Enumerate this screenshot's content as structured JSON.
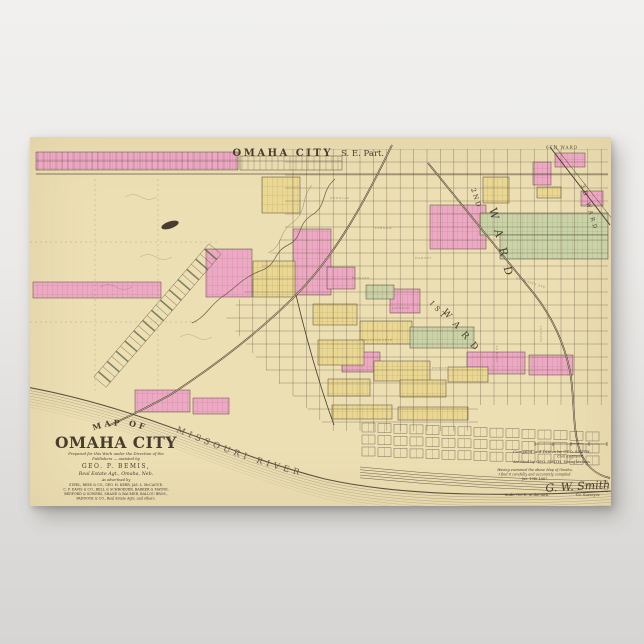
{
  "poster": {
    "paper_color": "#ecdfb4",
    "ink_color": "#473d2f",
    "palette": {
      "pink": "#eda8c3",
      "yellow": "#e9d792",
      "green": "#c9d3a7",
      "grid": "#6d5c44",
      "bank": "#5d5140"
    },
    "map_title": "OMAHA CITY",
    "map_title_suffix": "S. E. Part.",
    "river_label": "MISSOURI   RIVER",
    "ward_labels": [
      {
        "text": "6TH WARD",
        "x": 516,
        "y": 12,
        "r": 0,
        "s": 4.2,
        "ls": 1,
        "o": 0.9
      },
      {
        "text": "2ND",
        "x": 441,
        "y": 52,
        "r": 72,
        "s": 6.5,
        "ls": 2,
        "o": 1
      },
      {
        "text": "WARD",
        "x": 459,
        "y": 72,
        "r": 76,
        "s": 11,
        "ls": 11,
        "o": 1
      },
      {
        "text": "3D WARD",
        "x": 551,
        "y": 48,
        "r": 74,
        "s": 5.5,
        "ls": 3,
        "o": 1
      },
      {
        "text": "1ST",
        "x": 399,
        "y": 166,
        "r": 48,
        "s": 7,
        "ls": 3,
        "o": 1
      },
      {
        "text": "WARD",
        "x": 412,
        "y": 175,
        "r": 50,
        "s": 9,
        "ls": 7,
        "o": 1
      }
    ],
    "street_labels": [
      {
        "text": "DOUGLAS",
        "x": 300,
        "y": 62,
        "r": 0,
        "s": 3
      },
      {
        "text": "FARNAM",
        "x": 345,
        "y": 92,
        "r": 0,
        "s": 3
      },
      {
        "text": "HARNEY",
        "x": 385,
        "y": 122,
        "r": 0,
        "s": 3
      },
      {
        "text": "HOWARD",
        "x": 322,
        "y": 142,
        "r": 0,
        "s": 3
      },
      {
        "text": "JACKSON",
        "x": 362,
        "y": 172,
        "r": 0,
        "s": 3
      },
      {
        "text": "LEAVENWORTH",
        "x": 332,
        "y": 204,
        "r": 0,
        "s": 3
      },
      {
        "text": "PIERCE",
        "x": 402,
        "y": 232,
        "r": 0,
        "s": 3
      },
      {
        "text": "ST. MARYS AVE",
        "x": 486,
        "y": 142,
        "r": 18,
        "s": 3
      },
      {
        "text": "10TH ST",
        "x": 512,
        "y": 205,
        "r": -90,
        "s": 3
      },
      {
        "text": "13TH ST",
        "x": 468,
        "y": 225,
        "r": -90,
        "s": 3
      }
    ],
    "title_block": {
      "arc_text": "MAP OF",
      "name": "OMAHA CITY",
      "lines": [
        {
          "t": "Prepared for this Work under the Direction of the",
          "s": 3.8,
          "y": 318,
          "i": 1
        },
        {
          "t": "Publishers — assisted by",
          "s": 3.8,
          "y": 323,
          "i": 1
        },
        {
          "t": "GEO. P. BEMIS,",
          "s": 6,
          "y": 331,
          "ls": 1.5
        },
        {
          "t": "Real Estate Agt., Omaha, Neb.",
          "s": 4.8,
          "y": 338,
          "i": 1
        },
        {
          "t": "As advertised by",
          "s": 3.4,
          "y": 344,
          "i": 1
        },
        {
          "t": "STEEL, REES & CO., GEO. H. KERR, JAS. L. McCAGUE,",
          "s": 3.3,
          "y": 349
        },
        {
          "t": "C. F. DAVIS & CO., BELL & SCHROEDER, BARKER & MAYNE,",
          "s": 3.3,
          "y": 353.5
        },
        {
          "t": "BEDFORD & SOWERS, SHANE & BAUMER, BALLOU BROS.,",
          "s": 3.3,
          "y": 358
        },
        {
          "t": "PADDOCK & CO., Real Estate Agts. and others.",
          "s": 3.3,
          "y": 362.5
        }
      ]
    },
    "credits_block": {
      "lines": [
        {
          "t": "Compiled and Drawn by GEO. SMITH,",
          "s": 4,
          "y": 316
        },
        {
          "t": "Civil Engineer.",
          "s": 3.5,
          "y": 320.5,
          "x": 540,
          "i": 1
        },
        {
          "t": "Assisted by GEO. SMITH, Draughtsman.",
          "s": 3.8,
          "y": 326
        },
        {
          "t": "Having examined the above Map of Omaha,",
          "s": 3.4,
          "y": 334,
          "x": 505,
          "i": 1
        },
        {
          "t": "I find it carefully and accurately compiled.",
          "s": 3.4,
          "y": 338.5,
          "x": 505,
          "i": 1
        },
        {
          "t": "Jan. 15th 1887.",
          "s": 3.4,
          "y": 343,
          "x": 505,
          "i": 1
        }
      ],
      "signature": "G. W. Smith",
      "signature_title": "Co. Surveyor.",
      "scale_note": "Scale 700 ft. to the inch."
    },
    "blocks": {
      "pink": [
        [
          6,
          15,
          202,
          18
        ],
        [
          525,
          16,
          30,
          14
        ],
        [
          503,
          25,
          18,
          23
        ],
        [
          551,
          54,
          22,
          15
        ],
        [
          400,
          68,
          56,
          44
        ],
        [
          263,
          92,
          38,
          66
        ],
        [
          176,
          112,
          46,
          48
        ],
        [
          297,
          130,
          28,
          22
        ],
        [
          3,
          145,
          128,
          16
        ],
        [
          360,
          152,
          30,
          24
        ],
        [
          312,
          215,
          38,
          20
        ],
        [
          437,
          215,
          58,
          22
        ],
        [
          499,
          218,
          44,
          20
        ],
        [
          105,
          253,
          55,
          22
        ],
        [
          163,
          261,
          36,
          16
        ]
      ],
      "yellow": [
        [
          232,
          40,
          38,
          36
        ],
        [
          453,
          40,
          26,
          26
        ],
        [
          507,
          50,
          24,
          11
        ],
        [
          223,
          124,
          42,
          36
        ],
        [
          283,
          167,
          44,
          21
        ],
        [
          330,
          184,
          52,
          23
        ],
        [
          288,
          203,
          46,
          25
        ],
        [
          344,
          224,
          56,
          20
        ],
        [
          298,
          242,
          42,
          17
        ],
        [
          370,
          243,
          46,
          17
        ],
        [
          418,
          230,
          40,
          15
        ],
        [
          302,
          268,
          60,
          14
        ],
        [
          368,
          270,
          70,
          13
        ]
      ],
      "green": [
        [
          450,
          76,
          128,
          22
        ],
        [
          470,
          98,
          108,
          24
        ],
        [
          380,
          190,
          64,
          21
        ],
        [
          336,
          148,
          28,
          14
        ]
      ]
    }
  }
}
